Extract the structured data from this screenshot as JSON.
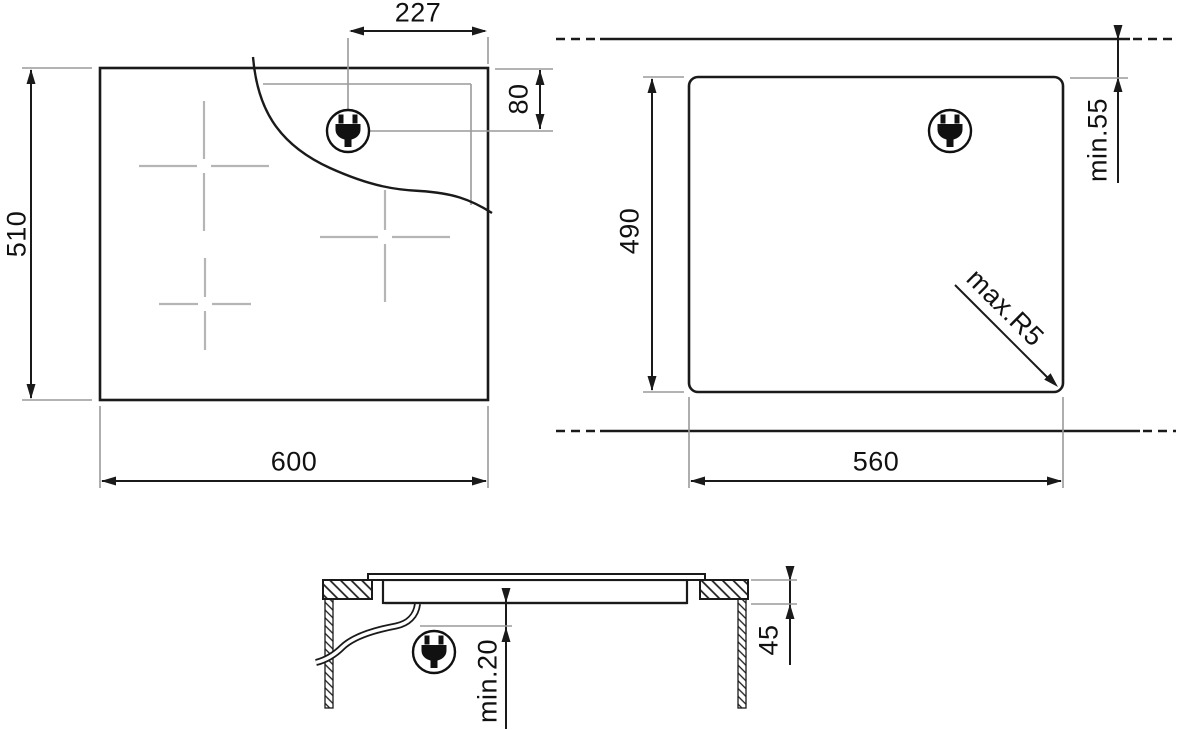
{
  "diagram": {
    "title": "hob-installation-drawing",
    "top_view": {
      "width": "600",
      "height": "510",
      "plug_from_right": "227",
      "plug_from_top": "80"
    },
    "cutout_view": {
      "width": "560",
      "height": "490",
      "min_wall_clearance": "min.55",
      "max_corner_radius": "max.R5"
    },
    "section_view": {
      "recess_depth": "45",
      "min_clearance_below": "min.20"
    },
    "icons": {
      "plug": "power-plug-icon"
    },
    "colors": {
      "line": "#1a1a1a",
      "extension": "#9a9a9a",
      "burner_cross": "#b5b5b5",
      "background": "#ffffff"
    }
  }
}
